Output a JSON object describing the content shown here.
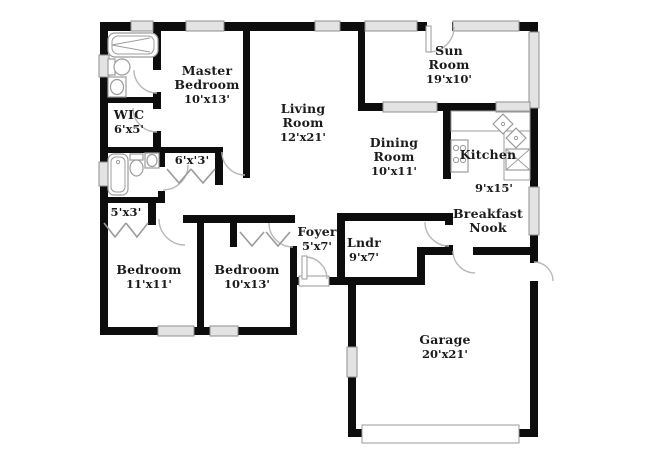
{
  "plan": {
    "type": "floor-plan",
    "rooms": [
      {
        "id": "master-bedroom",
        "name": "Master Bedroom",
        "dims": "10'x13'"
      },
      {
        "id": "wic",
        "name": "WIC",
        "dims": "6'x5'"
      },
      {
        "id": "living-room",
        "name": "Living Room",
        "dims": "12'x21'"
      },
      {
        "id": "sun-room",
        "name": "Sun Room",
        "dims": "19'x10'"
      },
      {
        "id": "dining-room",
        "name": "Dining Room",
        "dims": "10'x11'"
      },
      {
        "id": "kitchen",
        "name": "Kitchen",
        "dims": "9'x15'"
      },
      {
        "id": "breakfast-nook",
        "name": "Breakfast Nook",
        "dims": ""
      },
      {
        "id": "foyer",
        "name": "Foyer",
        "dims": "5'x7'"
      },
      {
        "id": "laundry",
        "name": "Lndr",
        "dims": "9'x7'"
      },
      {
        "id": "bedroom-2",
        "name": "Bedroom",
        "dims": "11'x11'"
      },
      {
        "id": "bedroom-3",
        "name": "Bedroom",
        "dims": "10'x13'"
      },
      {
        "id": "closet-5x3",
        "name": "5'x3'",
        "dims": ""
      },
      {
        "id": "closet-6x3",
        "name": "6'x'3'",
        "dims": ""
      },
      {
        "id": "garage",
        "name": "Garage",
        "dims": "20'x21'"
      }
    ],
    "fixture_icons": [
      "bathtub-icon",
      "toilet-icon",
      "sink-icon",
      "stove-icon",
      "kitchen-corner-sink-icon",
      "refrigerator-icon",
      "garage-door",
      "window",
      "door-swing",
      "bifold-closet-doors"
    ],
    "colors": {
      "wall": "#0d0d0d",
      "window_fill": "#e3e3e3",
      "window_border": "#8f8f8f",
      "door_arc": "#b8b8b8",
      "fixture": "#9c9c9c",
      "text": "#1b1b1b",
      "background": "#ffffff"
    }
  }
}
